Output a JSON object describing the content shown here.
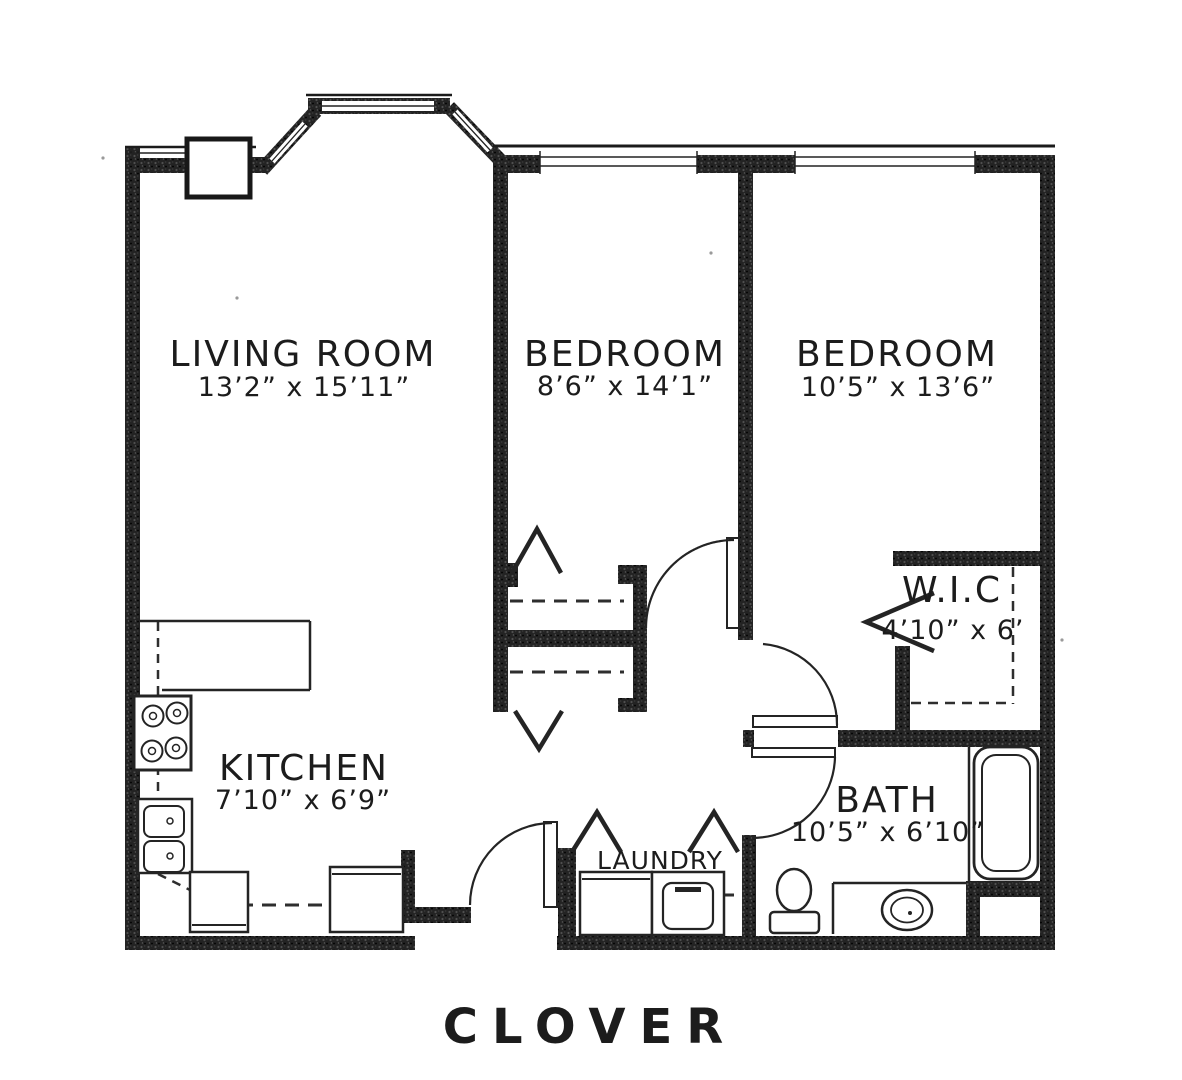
{
  "title": "CLOVER",
  "title_color": "#3e4956",
  "rooms": {
    "living_room": {
      "label": "LIVING ROOM",
      "dims": "13’2” x 15’11”"
    },
    "bedroom1": {
      "label": "BEDROOM",
      "dims": "8’6” x 14’1”"
    },
    "bedroom2": {
      "label": "BEDROOM",
      "dims": "10’5” x 13’6”"
    },
    "wic": {
      "label": "W.I.C",
      "dims": "4’10” x 6’"
    },
    "kitchen": {
      "label": "KITCHEN",
      "dims": "7’10” x 6’9”"
    },
    "bath": {
      "label": "BATH",
      "dims": "10’5” x 6’10”"
    },
    "laundry": {
      "label": "LAUNDRY"
    }
  }
}
